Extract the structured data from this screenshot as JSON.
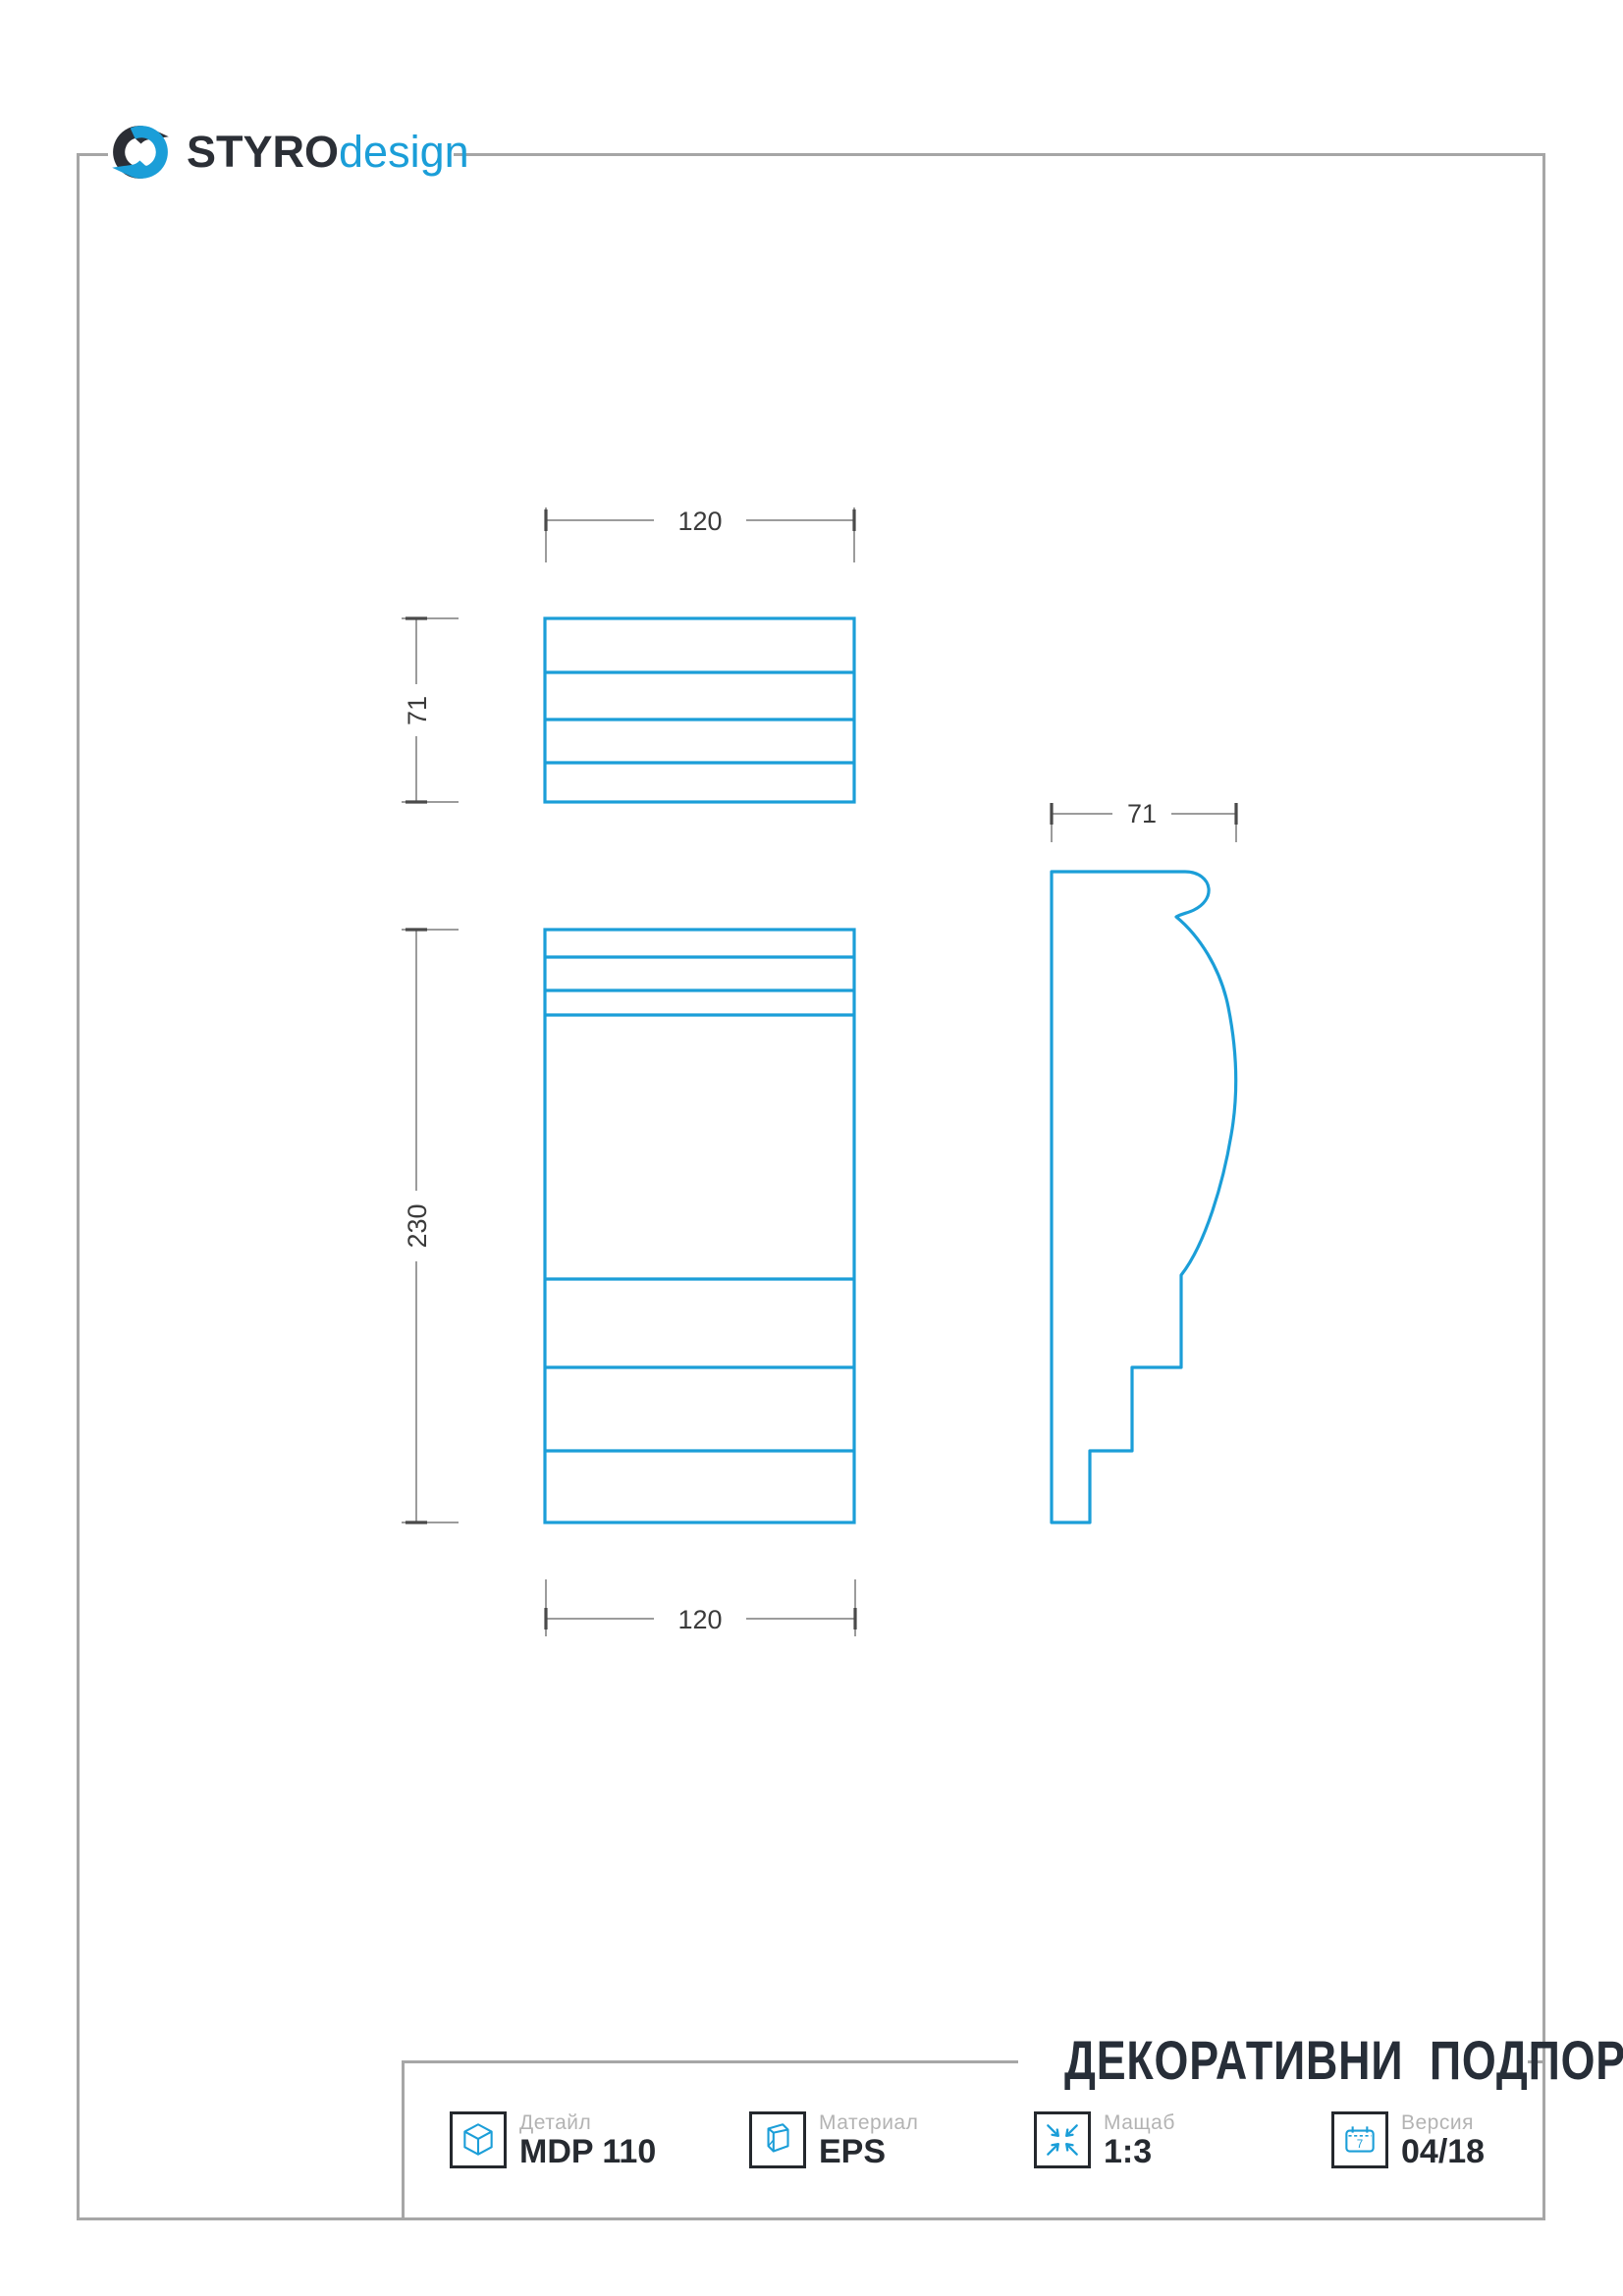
{
  "logo": {
    "brand_primary": "STYRO",
    "brand_secondary": "design"
  },
  "drawing": {
    "dim_top_width": "120",
    "dim_top_view_height": "71",
    "dim_front_height": "230",
    "dim_front_width": "120",
    "dim_side_width": "71"
  },
  "title_block": {
    "title": "ДЕКОРАТИВНИ  ПОДПОРИ",
    "fields": [
      {
        "label": "Детайл",
        "value": "MDP 110",
        "icon": "cube-icon"
      },
      {
        "label": "Материал",
        "value": "EPS",
        "icon": "material-icon"
      },
      {
        "label": "Мащаб",
        "value": "1:3",
        "icon": "scale-icon"
      },
      {
        "label": "Версия",
        "value": "04/18",
        "icon": "calendar-icon"
      }
    ],
    "calendar_day": "7"
  },
  "colors": {
    "accent_blue": "#1b9ed8",
    "ink_dark": "#272e38",
    "frame_gray": "#a6a6a6",
    "dim_gray": "#9c9c9c",
    "label_gray": "#b3b3b3"
  }
}
